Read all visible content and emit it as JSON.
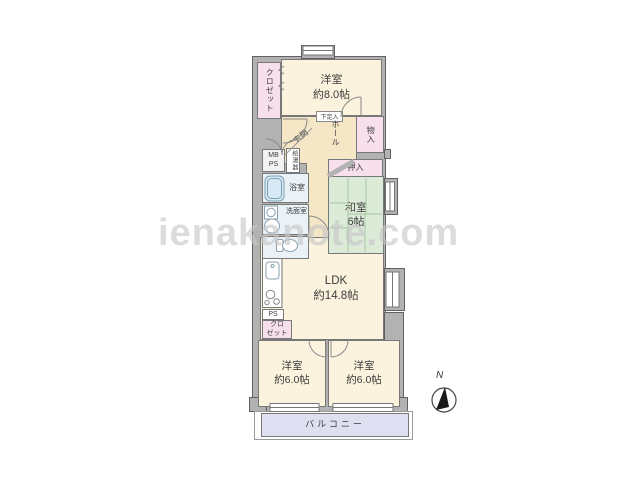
{
  "watermark": "ienakanote.com",
  "compass": {
    "north_label": "N"
  },
  "rooms": {
    "bedroom_top": {
      "name": "洋室",
      "size": "約8.0帖"
    },
    "ldk": {
      "name": "LDK",
      "size": "約14.8帖"
    },
    "washitsu": {
      "name": "和室",
      "size": "6帖"
    },
    "bedroom_left": {
      "name": "洋室",
      "size": "約6.0帖"
    },
    "bedroom_right": {
      "name": "洋室",
      "size": "約6.0帖"
    },
    "balcony": {
      "name": "バルコニー"
    }
  },
  "labels": {
    "closet_top": "クロゼット",
    "closet_ldk_line1": "クロ",
    "closet_ldk_line2": "ゼット",
    "genkan": "玄関",
    "hall": "ホール",
    "mono_ire": "物入",
    "oshiire": "押入",
    "getabako": "下足入",
    "mb": "MB",
    "ps_meter": "PS",
    "water_heater": "給湯器",
    "bathroom": "浴室",
    "washroom": "洗面室",
    "ps": "PS"
  },
  "colors": {
    "room_cream": "#fbf3dd",
    "hall_tan": "#f5e6c6",
    "closet_pink": "#f7e0ec",
    "tatami_green": "#dcebd7",
    "wet_blue": "#eaf2f8",
    "balcony_lavender": "#dfdff2",
    "wall_gray": "#b2b2b2",
    "watermark_gray": "#c7c7c7"
  }
}
